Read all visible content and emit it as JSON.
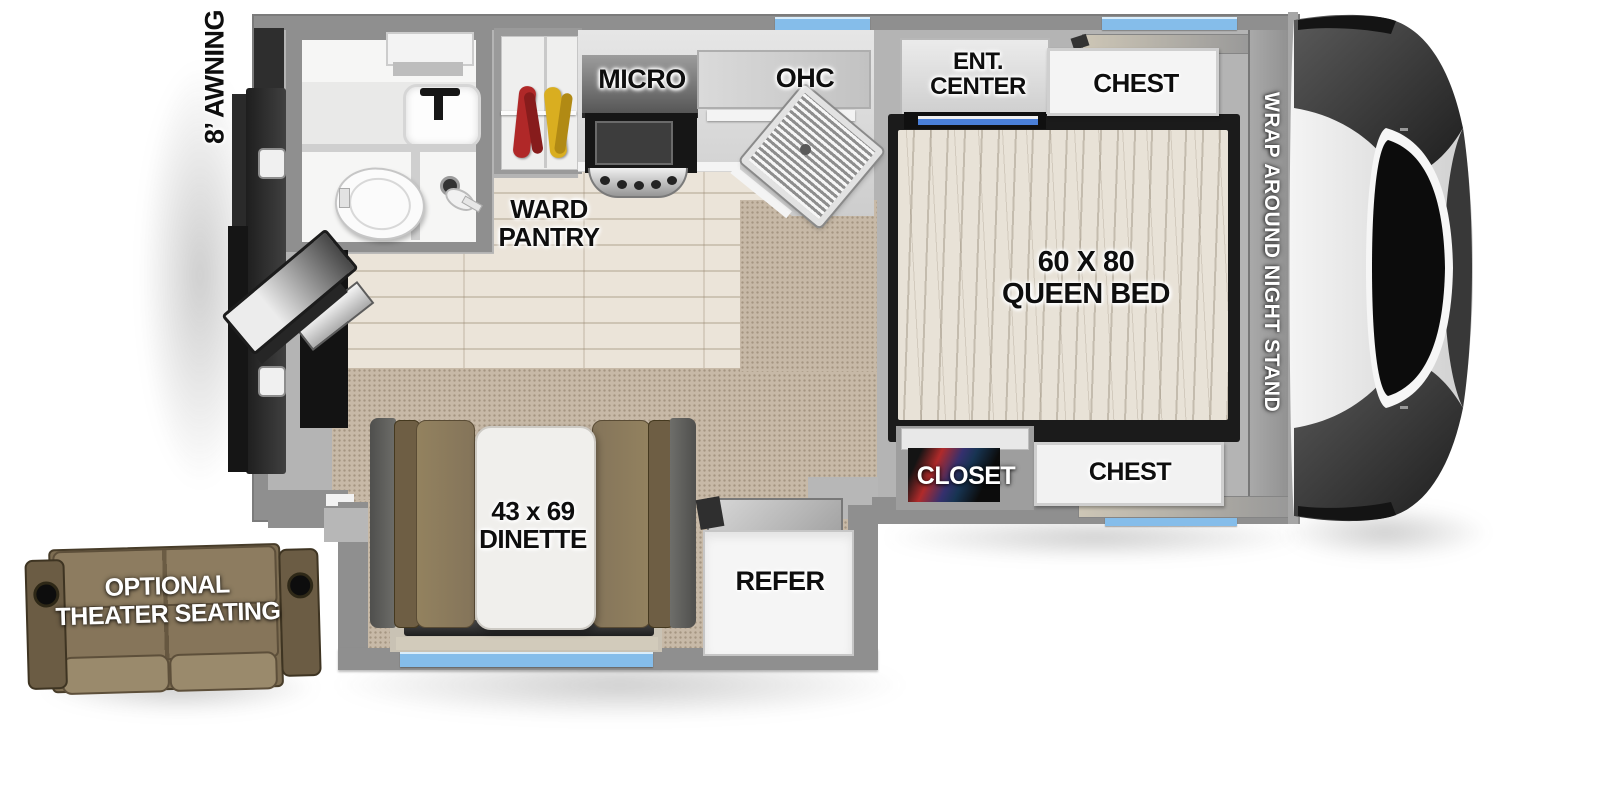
{
  "title": "Truck camper floorplan diagram",
  "labels": {
    "awning": "8’ AWNING",
    "ward1": "WARD",
    "ward2": "PANTRY",
    "micro": "MICRO",
    "ohc": "OHC",
    "ent1": "ENT.",
    "ent2": "CENTER",
    "chest_front": "CHEST",
    "bed1": "60 X 80",
    "bed2": "QUEEN BED",
    "nightstand": "WRAP AROUND NIGHT STAND",
    "closet": "CLOSET",
    "chest_rear": "CHEST",
    "dinette1": "43 x 69",
    "dinette2": "DINETTE",
    "refer": "REFER",
    "theater1": "OPTIONAL",
    "theater2": "THEATER SEATING"
  },
  "colors": {
    "wall": "#8f8f8f",
    "window_accent": "#85bdea",
    "carpet": "#c7b9a7",
    "wood_floor": "#ebe4d9",
    "mattress": "#e8e2d7",
    "bench_cushion": "#8d7c5e",
    "sofa": "#84745a",
    "label_text": "#0e0e0e"
  }
}
